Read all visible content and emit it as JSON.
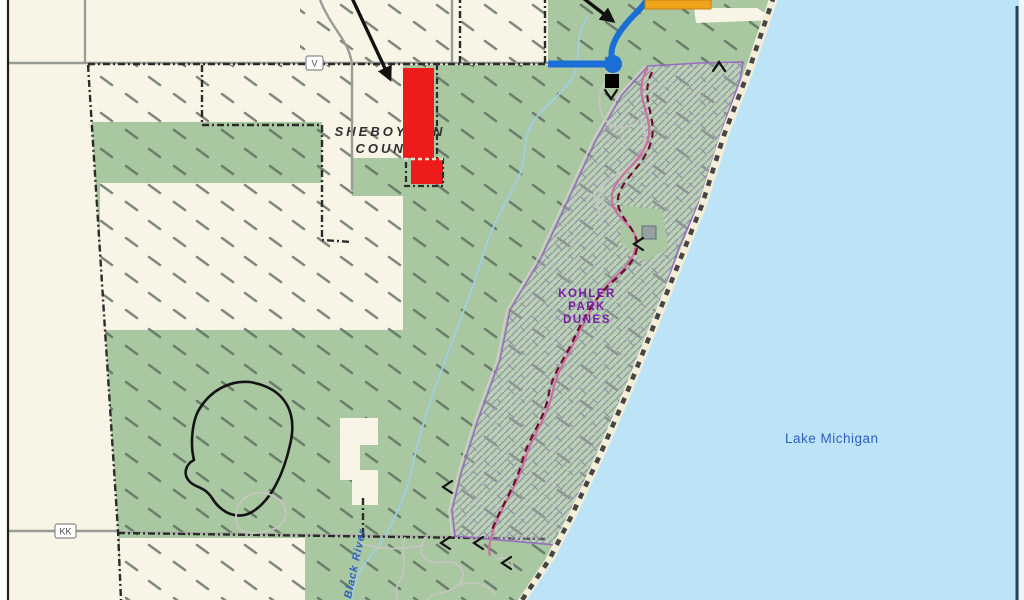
{
  "map": {
    "labels": {
      "county": {
        "line1": "SHEBOYGAN",
        "line2": "COUNTY"
      },
      "park": {
        "line1": "KOHLER",
        "line2": "PARK",
        "line3": "DUNES"
      },
      "lake": "Lake Michigan",
      "river": "Black River"
    },
    "road_labels": {
      "v": "V",
      "kk": "KK"
    },
    "colors": {
      "land_cream": "#f8f5e6",
      "forest_green": "#a9c7a0",
      "lake_blue": "#bde3f6",
      "beach_sand": "#f3eed9",
      "highlight_red": "#ee1b1b",
      "highlight_orange": "#f0a41c",
      "river_blue": "#1a6fd6",
      "dunes_boundary_purple": "#9a6cc0",
      "trail_pink": "#cc6fa4",
      "trail_maroon": "#6b0f28",
      "park_label_purple": "#7c1ba6",
      "water_label_blue": "#2f5fc0"
    }
  }
}
